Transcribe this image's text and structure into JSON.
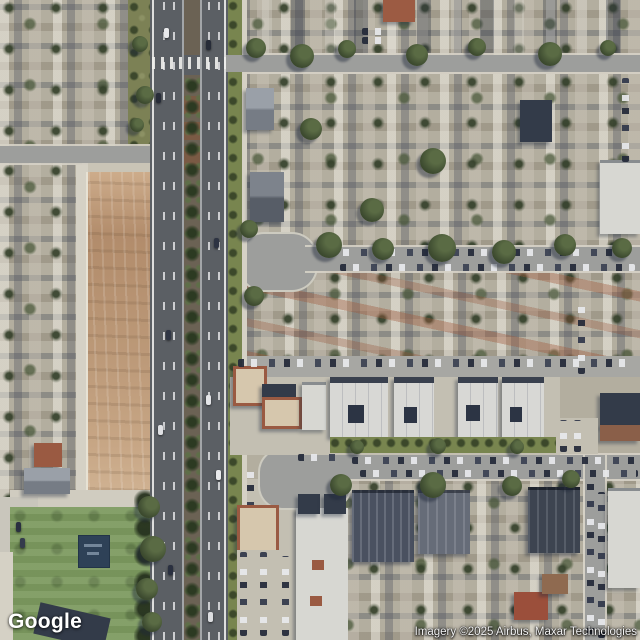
{
  "map": {
    "view": "satellite",
    "logo_text": "Google",
    "attribution": "Imagery ©2025 Airbus, Maxar Technologies",
    "colors": {
      "asphalt": "#5b5f64",
      "street": "#9d9e9c",
      "sidewalk": "#d5d1c5",
      "concrete": "#c3bfb2",
      "grass-parkway": "#78854f",
      "median-dirt": "#6b6254",
      "median-brick": "#7a5a44",
      "dirt-lot": "#bb9877",
      "field-green": "#7d9a60",
      "playground-blue": "#2e4157",
      "roof-white": "#d8d8d5",
      "roof-dark": "#333b49",
      "roof-red": "#9a5a42",
      "residential-base": "#b3ae9f"
    },
    "features": [
      "main-boulevard-with-palm-median",
      "crosswalk-intersection",
      "vacant-dirt-lot",
      "school-sports-field",
      "playground",
      "north-cul-de-sac",
      "south-cul-de-sac",
      "white-apartment-row",
      "dark-apartment-blocks",
      "parking-lots",
      "residential-neighborhood"
    ]
  }
}
